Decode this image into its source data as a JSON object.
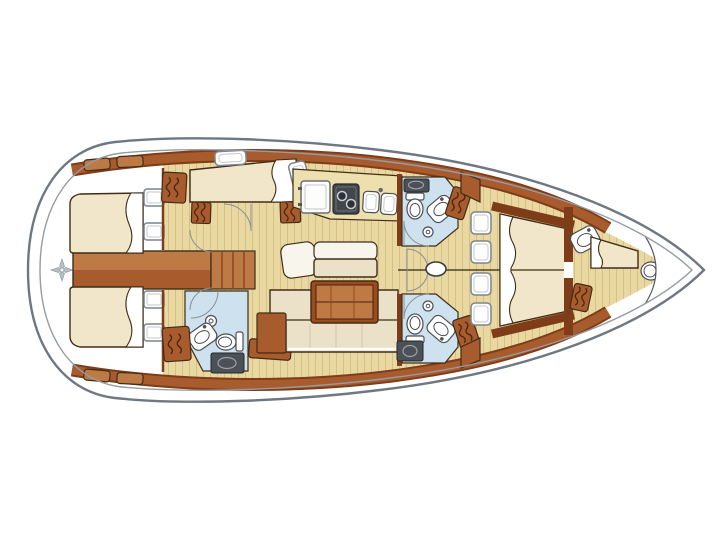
{
  "diagram": {
    "title": "Sailing yacht interior layout floor plan, bow to the right",
    "type": "yacht-interior-floor-plan",
    "orientation": "bow-right",
    "vessel": {
      "style": "monohull sailing yacht",
      "cabins": 5,
      "heads": 3
    },
    "rooms": [
      {
        "id": "stern-platform",
        "fixtures": [
          "compass-rose-icon"
        ]
      },
      {
        "id": "aft-cabin-port",
        "fixtures": [
          "double-berth",
          "pillows",
          "hull-window",
          "hull-window",
          "side-deck-lockers"
        ]
      },
      {
        "id": "aft-cabin-starboard",
        "fixtures": [
          "double-berth",
          "pillows",
          "hull-window",
          "hull-window",
          "side-deck-lockers"
        ]
      },
      {
        "id": "engine-compartment",
        "fixtures": [
          "companionway-steps"
        ]
      },
      {
        "id": "mid-cabin-port",
        "fixtures": [
          "berth",
          "pillow",
          "hanging-locker",
          "hanging-locker",
          "hanging-locker",
          "cabin-door",
          "deck-hatch"
        ]
      },
      {
        "id": "aft-head-starboard",
        "fixtures": [
          "toilet",
          "washbasin",
          "shower",
          "hanging-locker",
          "utility-unit",
          "cabin-door"
        ]
      },
      {
        "id": "galley",
        "fixtures": [
          "refrigerator",
          "two-burner-stove",
          "double-sink",
          "worktop",
          "deck-hatch"
        ]
      },
      {
        "id": "saloon",
        "fixtures": [
          "dining-table",
          "l-shaped-settee",
          "bench-seat",
          "chaise-seat",
          "storage-cabinet",
          "side-locker"
        ]
      },
      {
        "id": "forward-head-port",
        "fixtures": [
          "vanity-counter",
          "toilet",
          "washbasin",
          "shower",
          "hanging-locker",
          "cabin-door"
        ]
      },
      {
        "id": "forward-head-starboard",
        "fixtures": [
          "toilet",
          "washbasin",
          "shower",
          "hanging-locker",
          "utility-unit",
          "cabin-door"
        ]
      },
      {
        "id": "corridor",
        "fixtures": [
          "mast-base",
          "cabin-door",
          "centerline-seam"
        ]
      },
      {
        "id": "forward-cabin",
        "fixtures": [
          "v-berth",
          "pillows",
          "hull-window",
          "hull-window",
          "hull-window",
          "hull-window"
        ]
      },
      {
        "id": "forepeak-crew-cabin",
        "fixtures": [
          "single-berth",
          "washbasin",
          "toilet",
          "hanging-locker"
        ]
      },
      {
        "id": "bow",
        "fixtures": [
          "anchor-locker"
        ]
      }
    ]
  },
  "colors": {
    "page_bg": "#ffffff",
    "hull_line": "#6f7780",
    "hull_inner_line": "#959ca3",
    "outline_dark": "#3f2d17",
    "wood_dark": "#7e3c18",
    "wood_mid": "#a85c2e",
    "wood_light": "#bd7a45",
    "wood_red": "#9c4a1e",
    "floor_tan": "#e9d8a2",
    "plank_line": "#d6c084",
    "counter_tan": "#eedfae",
    "mattress_cream": "#f1e6ca",
    "cushion_cream": "#eae1c8",
    "seat_white": "#f8f5ec",
    "head_blue": "#cde2ee",
    "appliance_gray": "#4b5157",
    "metal_gray": "#9aa1a8",
    "window_stroke": "#7d848b",
    "door_line": "#8a9096",
    "squiggle_brown": "#4a2512",
    "fixture_line": "#4b4f54"
  }
}
